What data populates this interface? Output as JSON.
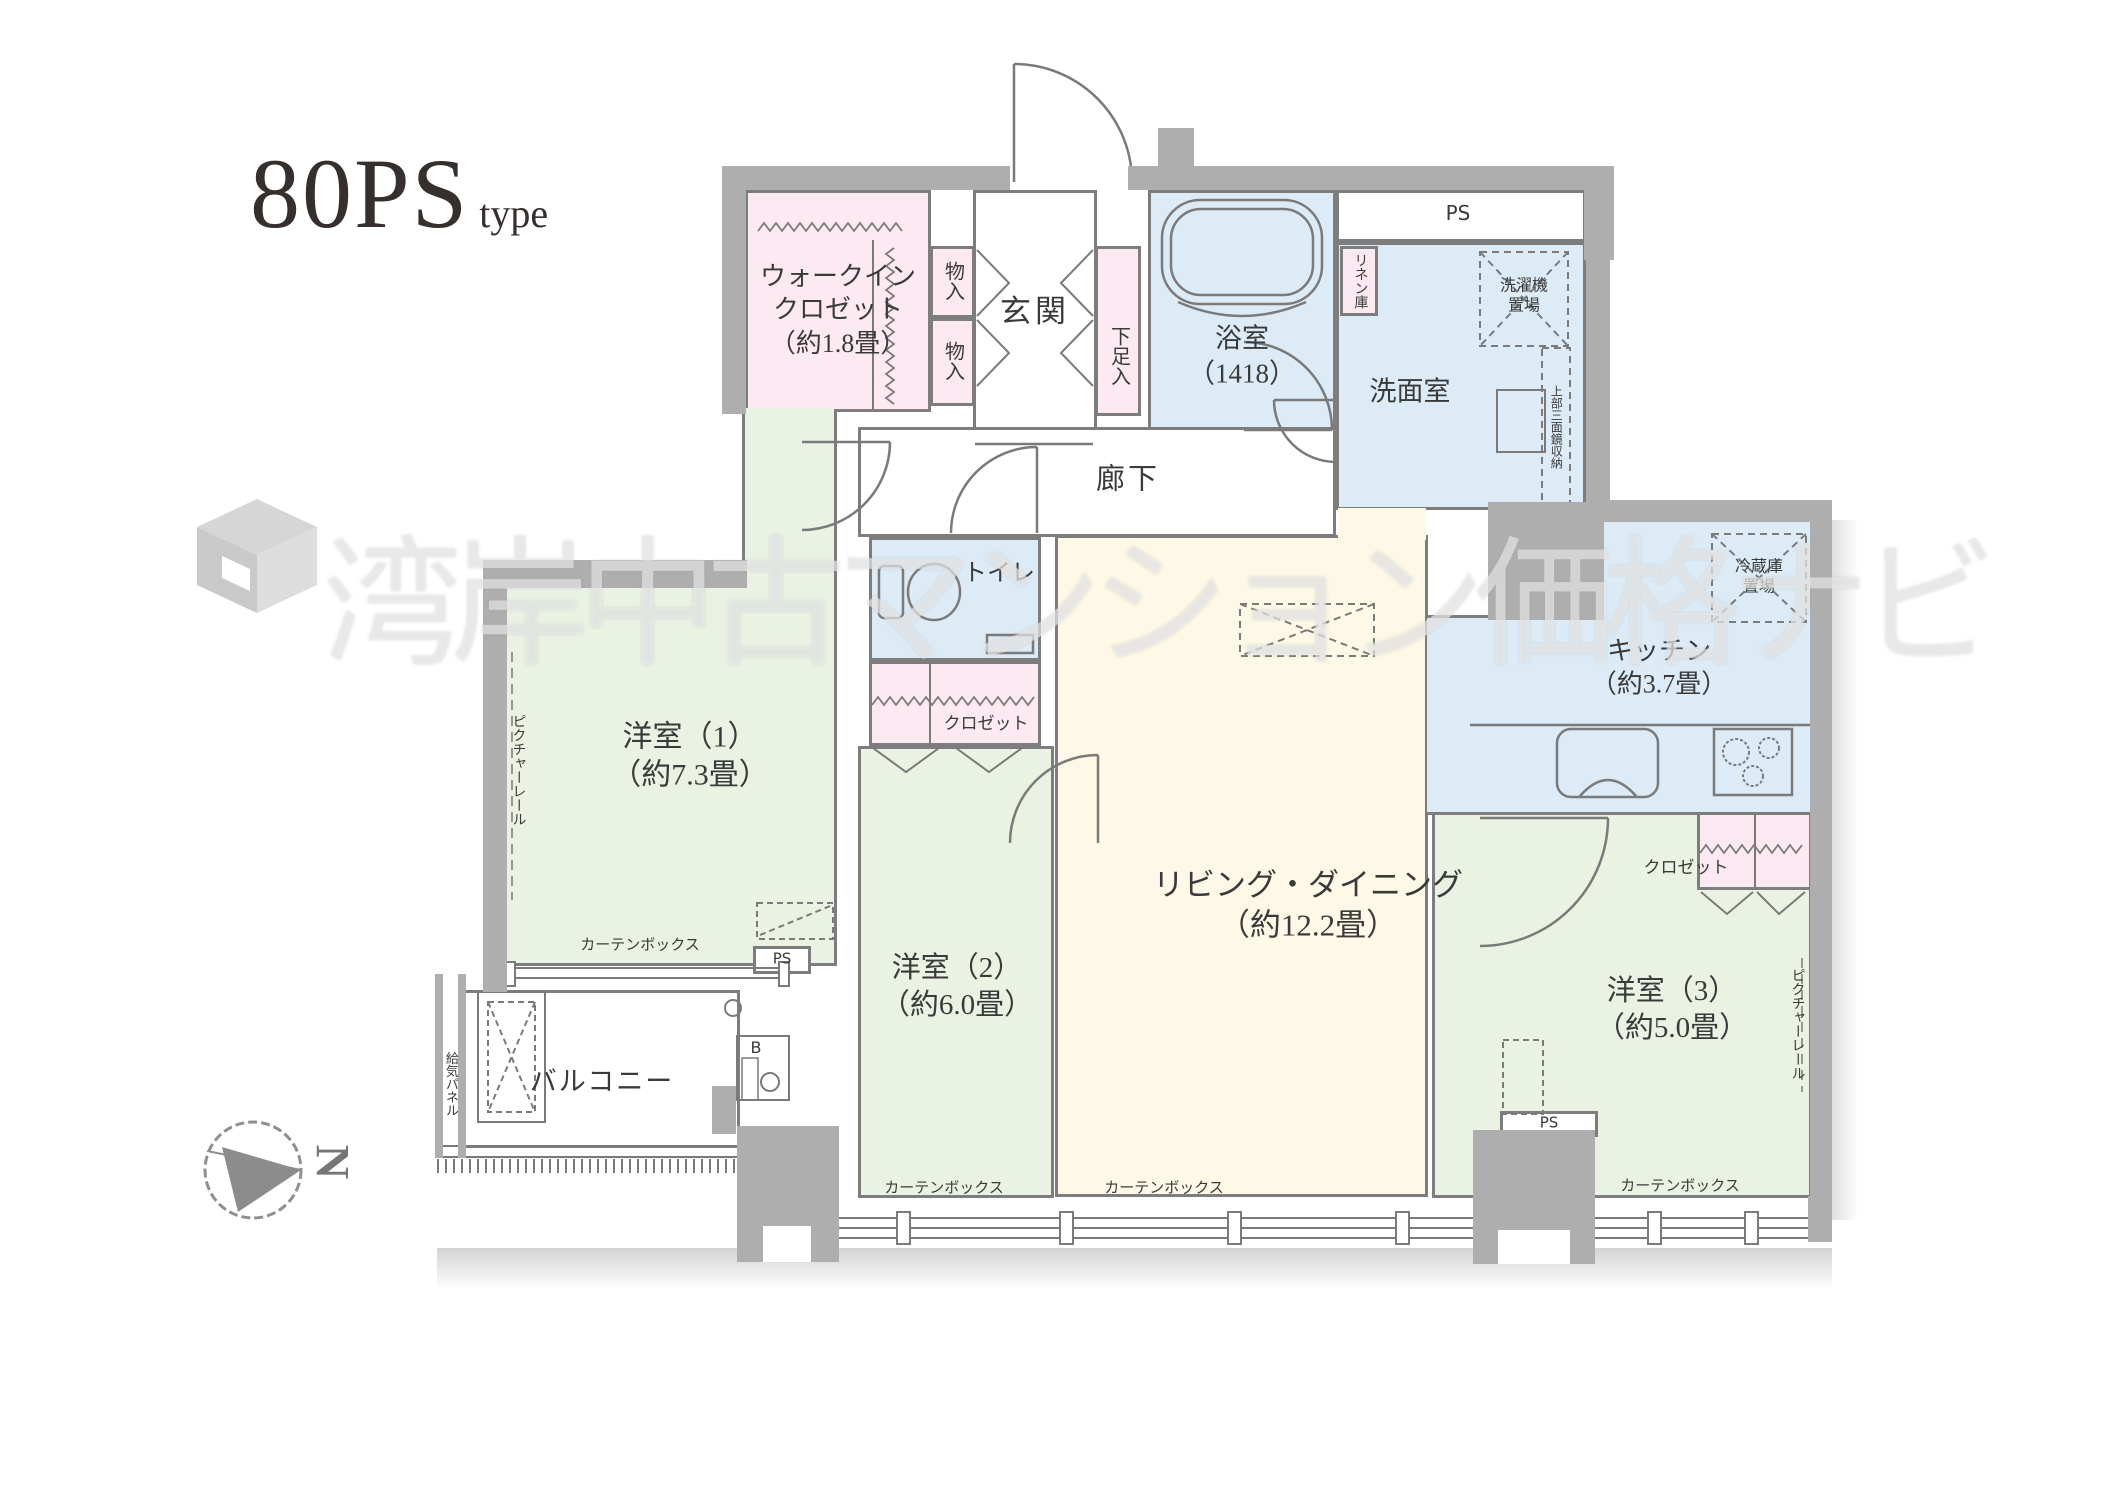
{
  "title": {
    "main": "80PS",
    "sub": "type"
  },
  "watermark": {
    "text": "湾岸中古マンション価格ナビ"
  },
  "compass": {
    "letter": "N"
  },
  "colors": {
    "wall": "#aeaeae",
    "line": "#7d7d7d",
    "closet_pink": "#fce9f1",
    "wet_blue": "#dcebf6",
    "bedroom_green": "#e9f2e3",
    "living_cream": "#fdf9e6"
  },
  "labels": {
    "wic1": "ウォークイン",
    "wic2": "クロゼット",
    "wic3": "（約1.8畳）",
    "mono": "物入",
    "genkan": "玄関",
    "geta": "下足入",
    "bath1": "浴室",
    "bath2": "（1418）",
    "linen": "リネン庫",
    "ps": "PS",
    "washer1": "洗濯機",
    "washer2": "置場",
    "senmen": "洗面室",
    "mirror": "上部三面鏡収納",
    "rouka": "廊下",
    "toilet": "トイレ",
    "closet": "クロゼット",
    "y1a": "洋室（1）",
    "y1b": "（約7.3畳）",
    "y2a": "洋室（2）",
    "y2b": "（約6.0畳）",
    "y3a": "洋室（3）",
    "y3b": "（約5.0畳）",
    "ld1": "リビング・ダイニング",
    "ld2": "（約12.2畳）",
    "kitchen1": "キッチン",
    "kitchen2": "（約3.7畳）",
    "fridge1": "冷蔵庫",
    "fridge2": "置場",
    "picture_rail": "ピクチャーレール",
    "curtain_box": "カーテンボックス",
    "balcony": "バルコニー",
    "kyuki": "給気パネル",
    "b_mark": "B"
  }
}
